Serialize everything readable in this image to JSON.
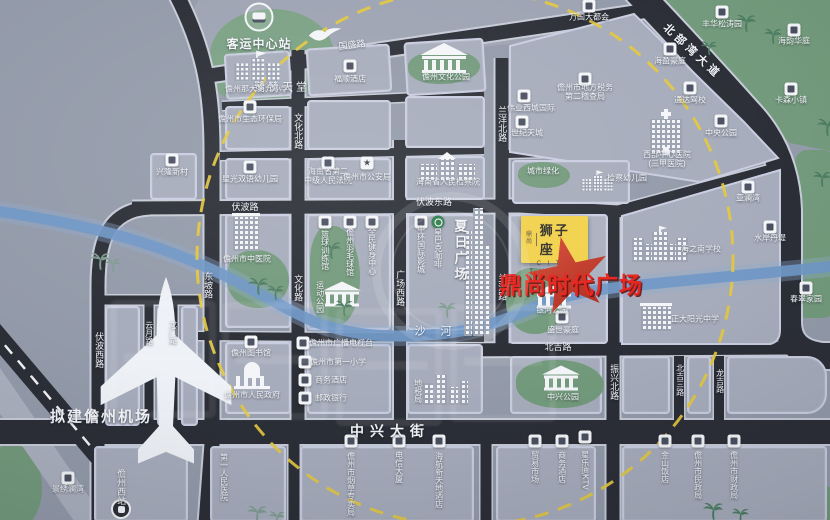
{
  "project": {
    "badge_prefix": "鼎尚",
    "badge_name": "狮子座",
    "badge_en_1": "C I T Y",
    "badge_en_2": "T H R O N E",
    "highlight": "鼎尚时代广场",
    "badge_color": "#f1d14b",
    "star_color": "#c9382b",
    "highlight_color": "#e8231c",
    "circle_color": "#e4c83e"
  },
  "labels": [
    {
      "n": "label-egret-paradise",
      "t": "鹭鸶天堂",
      "x": 282,
      "y": 88,
      "s": 11,
      "ls": 3
    },
    {
      "n": "label-planned-airport",
      "t": "拟建儋州机场",
      "x": 101,
      "y": 417,
      "s": 15,
      "w": 1,
      "ls": 2
    },
    {
      "n": "label-bus-center-station",
      "t": "客运中心站",
      "x": 259,
      "y": 45,
      "s": 12,
      "w": 1,
      "ls": 1
    },
    {
      "n": "label-guosheng-road",
      "t": "国盛路",
      "x": 352,
      "y": 45,
      "s": 9,
      "r": -7
    },
    {
      "n": "label-beibuwan-avenue",
      "t": "北部湾大道",
      "x": 692,
      "y": 52,
      "s": 11,
      "w": 1,
      "ls": 4,
      "r": 43
    },
    {
      "n": "label-wenhua-north-road",
      "t": "文化北路",
      "x": 298,
      "y": 131,
      "s": 9,
      "d": "v"
    },
    {
      "n": "label-wenhua-road",
      "t": "文化路",
      "x": 298,
      "y": 288,
      "s": 9,
      "d": "v"
    },
    {
      "n": "label-lanyang-north-road",
      "t": "兰洋北路",
      "x": 502,
      "y": 124,
      "s": 9,
      "d": "v"
    },
    {
      "n": "label-lanyang-road",
      "t": "兰洋路",
      "x": 502,
      "y": 287,
      "s": 9,
      "d": "v"
    },
    {
      "n": "label-fubo-road",
      "t": "伏波路",
      "x": 245,
      "y": 207,
      "s": 9
    },
    {
      "n": "label-fubo-east-road",
      "t": "伏波东路",
      "x": 434,
      "y": 202,
      "s": 9
    },
    {
      "n": "label-dongpo-road",
      "t": "东坡路",
      "x": 208,
      "y": 285,
      "s": 9,
      "d": "v"
    },
    {
      "n": "label-guangchang-west-road",
      "t": "广场西路",
      "x": 400,
      "y": 288,
      "s": 9,
      "d": "v"
    },
    {
      "n": "label-fubo-west-road",
      "t": "伏波西路",
      "x": 99,
      "y": 350,
      "s": 9,
      "d": "v"
    },
    {
      "n": "label-yunyue-road",
      "t": "云月路",
      "x": 149,
      "y": 333,
      "s": 8,
      "d": "v"
    },
    {
      "n": "label-longmen-road",
      "t": "龙门路",
      "x": 173,
      "y": 332,
      "s": 8,
      "d": "v"
    },
    {
      "n": "label-zhongxing-avenue",
      "t": "中兴大街",
      "x": 390,
      "y": 431,
      "s": 14,
      "w": 1,
      "ls": 6
    },
    {
      "n": "label-beiji-road",
      "t": "北吉路",
      "x": 558,
      "y": 347,
      "s": 9
    },
    {
      "n": "label-zhenxing-north-road",
      "t": "振兴北路",
      "x": 614,
      "y": 382,
      "s": 9,
      "d": "v"
    },
    {
      "n": "label-beiji-3rd-road",
      "t": "北吉三路",
      "x": 680,
      "y": 380,
      "s": 8,
      "d": "v"
    },
    {
      "n": "label-longji-road",
      "t": "龙吉路",
      "x": 720,
      "y": 381,
      "s": 8,
      "d": "v"
    },
    {
      "n": "label-shahe-river",
      "t": "沙 河",
      "x": 436,
      "y": 332,
      "s": 11,
      "ls": 6,
      "c": "river"
    },
    {
      "n": "label-danzhou-west-station",
      "t": "儋州西站",
      "x": 121,
      "y": 487,
      "s": 9,
      "d": "v"
    },
    {
      "n": "label-no9-primary-school",
      "t": "儋州那大第九小学",
      "x": 257,
      "y": 89
    },
    {
      "n": "label-fushun-hotel",
      "t": "福顺酒店",
      "x": 350,
      "y": 79
    },
    {
      "n": "label-danzhou-culture-park",
      "t": "儋州文化公园",
      "x": 446,
      "y": 77
    },
    {
      "n": "label-wanguo-metropolis",
      "t": "万国大都会",
      "x": 589,
      "y": 17
    },
    {
      "n": "label-haiying-mansion",
      "t": "海盈豪庭",
      "x": 670,
      "y": 61
    },
    {
      "n": "label-fenghua-songtao-garden",
      "t": "丰华松涛园",
      "x": 722,
      "y": 24
    },
    {
      "n": "label-tax-bureau-no2",
      "t": "儋州市地方税务",
      "l2": "第二稽查局",
      "x": 585,
      "y": 92
    },
    {
      "n": "label-weiye-west-city",
      "t": "伟业西城国际",
      "x": 531,
      "y": 108
    },
    {
      "n": "label-century-sky-city",
      "t": "世纪天城",
      "x": 527,
      "y": 133
    },
    {
      "n": "label-driving-school",
      "t": "通达驾校",
      "x": 690,
      "y": 100
    },
    {
      "n": "label-central-park",
      "t": "中央公园",
      "x": 721,
      "y": 133
    },
    {
      "n": "label-west-central-hospital",
      "t": "西部中心医院",
      "l2": "(三甲医院)",
      "x": 667,
      "y": 159
    },
    {
      "n": "label-haiyun-huating",
      "t": "海韵华庭",
      "x": 794,
      "y": 41
    },
    {
      "n": "label-kasen-town",
      "t": "卡森小镇",
      "x": 791,
      "y": 100
    },
    {
      "n": "label-eco-environment-bureau",
      "t": "儋州市生态环保局",
      "x": 250,
      "y": 119
    },
    {
      "n": "label-xinglong-village",
      "t": "兴隆新村",
      "x": 172,
      "y": 172
    },
    {
      "n": "label-starlight-kindergarten",
      "t": "星光双语幼儿园",
      "x": 250,
      "y": 179
    },
    {
      "n": "label-no2-intermediate-court",
      "t": "海南省第二",
      "l2": "中级人民法院",
      "x": 328,
      "y": 176
    },
    {
      "n": "label-public-security-bureau",
      "t": "儋州市公安局",
      "x": 367,
      "y": 177
    },
    {
      "n": "label-procuratorate",
      "t": "海南省人民检察院",
      "x": 448,
      "y": 182
    },
    {
      "n": "label-urban-greening",
      "t": "城市绿化",
      "x": 543,
      "y": 171
    },
    {
      "n": "label-jiancha-kindergarten",
      "t": "检察幼儿园",
      "x": 627,
      "y": 178
    },
    {
      "n": "label-tcm-hospital",
      "t": "儋州市中医院",
      "x": 247,
      "y": 259
    },
    {
      "n": "label-basketball-gym",
      "t": "篮球训练馆",
      "x": 325,
      "y": 250,
      "d": "v"
    },
    {
      "n": "label-badminton-gym",
      "t": "儋州羽毛球馆",
      "x": 350,
      "y": 252,
      "d": "v"
    },
    {
      "n": "label-fitness-center",
      "t": "全民健身中心",
      "x": 372,
      "y": 251,
      "d": "v"
    },
    {
      "n": "label-sports-park",
      "t": "运动公园",
      "x": 320,
      "y": 297,
      "d": "v"
    },
    {
      "n": "label-cinema",
      "t": "中环国际影城",
      "x": 421,
      "y": 249,
      "d": "v"
    },
    {
      "n": "label-starbucks",
      "t": "星巴克咖啡",
      "x": 438,
      "y": 248,
      "d": "v"
    },
    {
      "n": "label-summer-plaza",
      "t": "夏日广场",
      "x": 459,
      "y": 251,
      "d": "v",
      "s": 13,
      "w": 1,
      "ls": 3
    },
    {
      "n": "label-galaxy-park",
      "t": "银河公园",
      "x": 552,
      "y": 310
    },
    {
      "n": "label-shengshi-mansion",
      "t": "盛世豪庭",
      "x": 563,
      "y": 330
    },
    {
      "n": "label-haizhinan-school",
      "t": "海之南学校",
      "x": 701,
      "y": 249
    },
    {
      "n": "label-zhengda-sunshine-school",
      "t": "正大阳光中学",
      "x": 695,
      "y": 319
    },
    {
      "n": "label-yalanwan",
      "t": "亚澜湾",
      "x": 748,
      "y": 198
    },
    {
      "n": "label-shuian-danti",
      "t": "水岸丹堤",
      "x": 770,
      "y": 238
    },
    {
      "n": "label-chuncui-garden",
      "t": "春翠家园",
      "x": 806,
      "y": 299
    },
    {
      "n": "label-danzhou-library",
      "t": "儋州图书馆",
      "x": 251,
      "y": 353
    },
    {
      "n": "label-municipal-government",
      "t": "儋州市人民政府",
      "x": 252,
      "y": 395
    },
    {
      "n": "label-radio-tv-station",
      "t": "儋州市广播电视台",
      "x": 341,
      "y": 343
    },
    {
      "n": "label-no1-primary-school",
      "t": "儋州市第一小学",
      "x": 338,
      "y": 362
    },
    {
      "n": "label-business-hotel-north",
      "t": "商务酒店",
      "x": 331,
      "y": 380
    },
    {
      "n": "label-postal-bank",
      "t": "邮政银行",
      "x": 331,
      "y": 398
    },
    {
      "n": "label-local-tax-bureau",
      "t": "地税局",
      "x": 418,
      "y": 391,
      "d": "v"
    },
    {
      "n": "label-zhongxing-park",
      "t": "中兴公园",
      "x": 563,
      "y": 397
    },
    {
      "n": "label-jingxiu-lanwan",
      "t": "景绣澜湾",
      "x": 68,
      "y": 489
    },
    {
      "n": "label-first-peoples-hospital",
      "t": "第一人民医院",
      "x": 224,
      "y": 477,
      "d": "v"
    },
    {
      "n": "label-tobacco-bureau",
      "t": "儋州市烟草专卖局",
      "x": 351,
      "y": 484,
      "d": "v"
    },
    {
      "n": "label-telecom-tower",
      "t": "电信大厦",
      "x": 399,
      "y": 467,
      "d": "v"
    },
    {
      "n": "label-hna-new-world-hotel",
      "t": "海航新天地酒店",
      "x": 439,
      "y": 480,
      "d": "v"
    },
    {
      "n": "label-trade-market",
      "t": "贸易市场",
      "x": 535,
      "y": 467,
      "d": "v"
    },
    {
      "n": "label-business-hotel-south",
      "t": "商务酒店",
      "x": 562,
      "y": 467,
      "d": "v"
    },
    {
      "n": "label-xingledi-ktv",
      "t": "星乐迪KTV",
      "x": 585,
      "y": 470,
      "d": "v"
    },
    {
      "n": "label-jinshan-hotel",
      "t": "金山饭店",
      "x": 665,
      "y": 467,
      "d": "v"
    },
    {
      "n": "label-civil-affairs-bureau",
      "t": "儋州市民政局",
      "x": 698,
      "y": 475,
      "d": "v"
    },
    {
      "n": "label-finance-bureau",
      "t": "儋州市财政局",
      "x": 734,
      "y": 475,
      "d": "v"
    }
  ],
  "markers": [
    {
      "n": "bus-station-icon",
      "k": "bus",
      "x": 259,
      "y": 17
    },
    {
      "n": "airplane-icon",
      "k": "plane",
      "x": 96,
      "y": 272
    },
    {
      "n": "egret-bird-icon",
      "k": "bird",
      "x": 307,
      "y": 25
    },
    {
      "n": "school-building-icon",
      "k": "school",
      "x": 257,
      "y": 66,
      "sc": 0.9
    },
    {
      "n": "poi-chip-fushun",
      "k": "chip",
      "x": 350,
      "y": 66
    },
    {
      "n": "temple-building-icon",
      "k": "temple",
      "x": 444,
      "y": 58
    },
    {
      "n": "poi-chip-wanguo",
      "k": "chip",
      "x": 589,
      "y": 6
    },
    {
      "n": "poi-chip-haiying",
      "k": "chip",
      "x": 670,
      "y": 49
    },
    {
      "n": "poi-chip-fenghua",
      "k": "chip",
      "x": 722,
      "y": 12
    },
    {
      "n": "poi-chip-tax",
      "k": "chip",
      "x": 585,
      "y": 79
    },
    {
      "n": "poi-chip-weiye",
      "k": "chip",
      "x": 524,
      "y": 96
    },
    {
      "n": "poi-chip-shiji",
      "k": "chip",
      "x": 522,
      "y": 122
    },
    {
      "n": "poi-chip-driving",
      "k": "chip",
      "x": 690,
      "y": 88
    },
    {
      "n": "poi-chip-centralpark",
      "k": "chip",
      "x": 721,
      "y": 121
    },
    {
      "n": "hospital-building-icon",
      "k": "hospital",
      "x": 666,
      "y": 132
    },
    {
      "n": "poi-chip-haiyun",
      "k": "chip",
      "x": 794,
      "y": 30
    },
    {
      "n": "poi-chip-kasen",
      "k": "chip",
      "x": 791,
      "y": 89
    },
    {
      "n": "poi-chip-eco",
      "k": "chip",
      "x": 250,
      "y": 107
    },
    {
      "n": "poi-chip-xinglong",
      "k": "chip",
      "x": 172,
      "y": 160
    },
    {
      "n": "poi-chip-starlight",
      "k": "chip",
      "x": 250,
      "y": 167
    },
    {
      "n": "poi-chip-court",
      "k": "chip",
      "x": 328,
      "y": 163
    },
    {
      "n": "police-star-icon",
      "k": "chipstar",
      "x": 367,
      "y": 163
    },
    {
      "n": "government-building-icon",
      "k": "govwide",
      "x": 447,
      "y": 167
    },
    {
      "n": "kindergarten-building-icon",
      "k": "school",
      "x": 597,
      "y": 181,
      "sc": 0.62
    },
    {
      "n": "tcm-hospital-building-icon",
      "k": "medbldg",
      "x": 246,
      "y": 232
    },
    {
      "n": "poi-chip-basketball",
      "k": "chip",
      "x": 325,
      "y": 222
    },
    {
      "n": "poi-chip-badminton",
      "k": "chip",
      "x": 350,
      "y": 222
    },
    {
      "n": "poi-chip-fitness",
      "k": "chip",
      "x": 372,
      "y": 222
    },
    {
      "n": "sports-colonnade-icon",
      "k": "colonn",
      "x": 342,
      "y": 294
    },
    {
      "n": "poi-chip-cinema",
      "k": "chip",
      "x": 421,
      "y": 222
    },
    {
      "n": "starbucks-icon",
      "k": "chipgreen",
      "x": 438,
      "y": 222
    },
    {
      "n": "summer-plaza-towers-icon",
      "k": "skyline",
      "x": 477,
      "y": 272
    },
    {
      "n": "haizhinan-palace-icon",
      "k": "palace",
      "x": 660,
      "y": 244
    },
    {
      "n": "zhengda-school-building-icon",
      "k": "bldg",
      "x": 656,
      "y": 317
    },
    {
      "n": "poi-chip-yalanwan",
      "k": "chip",
      "x": 748,
      "y": 187
    },
    {
      "n": "poi-chip-shuian",
      "k": "chip",
      "x": 770,
      "y": 227
    },
    {
      "n": "poi-chip-chuncui",
      "k": "chip",
      "x": 806,
      "y": 288
    },
    {
      "n": "poi-chip-library",
      "k": "chip",
      "x": 251,
      "y": 342
    },
    {
      "n": "dome-building-icon",
      "k": "dome",
      "x": 252,
      "y": 376
    },
    {
      "n": "poi-chip-tv",
      "k": "chip",
      "x": 303,
      "y": 343
    },
    {
      "n": "poi-chip-school1",
      "k": "chip",
      "x": 305,
      "y": 362
    },
    {
      "n": "poi-chip-hotel-n",
      "k": "chip",
      "x": 305,
      "y": 380
    },
    {
      "n": "poi-chip-bank",
      "k": "chip",
      "x": 305,
      "y": 398
    },
    {
      "n": "tax-towers-icon",
      "k": "skytowers",
      "x": 446,
      "y": 390
    },
    {
      "n": "park-colonnade-icon",
      "k": "colonn",
      "x": 561,
      "y": 378
    },
    {
      "n": "galaxy-colonnade-icon",
      "k": "colonn",
      "x": 554,
      "y": 296
    },
    {
      "n": "poi-chip-shengshi",
      "k": "chip",
      "x": 562,
      "y": 317
    },
    {
      "n": "poi-chip-jingxiu",
      "k": "chip",
      "x": 68,
      "y": 478
    },
    {
      "n": "rail-station-icon",
      "k": "rail",
      "x": 121,
      "y": 509
    },
    {
      "n": "poi-chip-tobacco",
      "k": "chip",
      "x": 351,
      "y": 441
    },
    {
      "n": "poi-chip-telecom",
      "k": "chip",
      "x": 399,
      "y": 441
    },
    {
      "n": "poi-chip-hna",
      "k": "chip",
      "x": 439,
      "y": 441
    },
    {
      "n": "poi-chip-trade",
      "k": "chip",
      "x": 535,
      "y": 441
    },
    {
      "n": "poi-chip-hotel-s",
      "k": "chip",
      "x": 562,
      "y": 441
    },
    {
      "n": "poi-chip-ktv",
      "k": "chip",
      "x": 585,
      "y": 437
    },
    {
      "n": "poi-chip-jinshan",
      "k": "chip",
      "x": 665,
      "y": 441
    },
    {
      "n": "poi-chip-civil",
      "k": "chip",
      "x": 698,
      "y": 441
    },
    {
      "n": "poi-chip-finance",
      "k": "chip",
      "x": 734,
      "y": 441
    },
    {
      "n": "palm-tree-icon",
      "k": "palmg",
      "x": 735,
      "y": 13
    },
    {
      "n": "palm-tree-icon",
      "k": "palmg",
      "x": 763,
      "y": 27,
      "sc": 0.9
    },
    {
      "n": "palm-tree-icon",
      "k": "palmg",
      "x": 700,
      "y": 40,
      "sc": 0.8
    },
    {
      "n": "palm-tree-icon",
      "k": "palmg",
      "x": 816,
      "y": 117
    },
    {
      "n": "palm-tree-icon",
      "k": "palmg",
      "x": 812,
      "y": 170,
      "sc": 0.9
    },
    {
      "n": "palm-tree-icon",
      "k": "palmy",
      "x": 89,
      "y": 251
    },
    {
      "n": "palm-tree-icon",
      "k": "palmy",
      "x": 104,
      "y": 257,
      "sc": 0.8
    },
    {
      "n": "palm-tree-icon",
      "k": "palmg",
      "x": 247,
      "y": 276
    },
    {
      "n": "palm-tree-icon",
      "k": "palmg",
      "x": 266,
      "y": 284,
      "sc": 0.85
    },
    {
      "n": "palm-tree-icon",
      "k": "palmg",
      "x": 320,
      "y": 240
    },
    {
      "n": "palm-tree-icon",
      "k": "palmg",
      "x": 334,
      "y": 299,
      "sc": 0.9
    },
    {
      "n": "palm-tree-icon",
      "k": "palmy",
      "x": 437,
      "y": 301,
      "sc": 0.9
    },
    {
      "n": "palm-tree-icon",
      "k": "palmg",
      "x": 702,
      "y": 501
    },
    {
      "n": "palm-tree-icon",
      "k": "palmg",
      "x": 731,
      "y": 507,
      "sc": 0.85
    },
    {
      "n": "palm-tree-icon",
      "k": "palmy",
      "x": 246,
      "y": 504
    },
    {
      "n": "palm-tree-icon",
      "k": "palmy",
      "x": 268,
      "y": 510,
      "sc": 0.8
    }
  ]
}
